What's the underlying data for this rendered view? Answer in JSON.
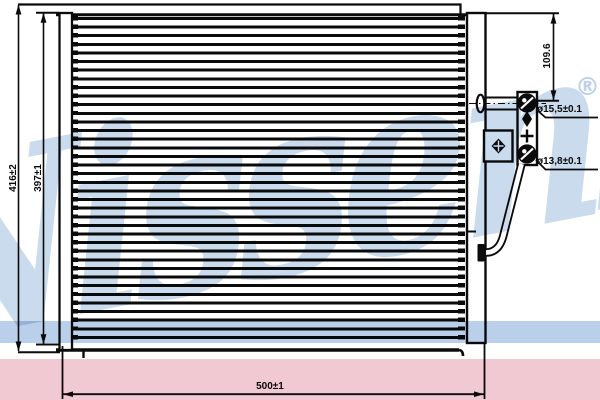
{
  "drawing": {
    "dim_overall_height": "416±2",
    "dim_core_height": "397±1",
    "dim_port_offset": "109.6",
    "dim_upper_port": "ø15,5±0.1",
    "dim_lower_port": "ø13,8±0.1",
    "dim_overall_width": "500±1"
  },
  "watermark": {
    "brand": "Nissens",
    "registered_mark": "®"
  },
  "colors": {
    "line_art": "#0b0b0b",
    "watermark_letters": "#c8d9ee",
    "watermark_band_blue": "#bacfe9",
    "watermark_band_pink": "#f1c9d3"
  }
}
